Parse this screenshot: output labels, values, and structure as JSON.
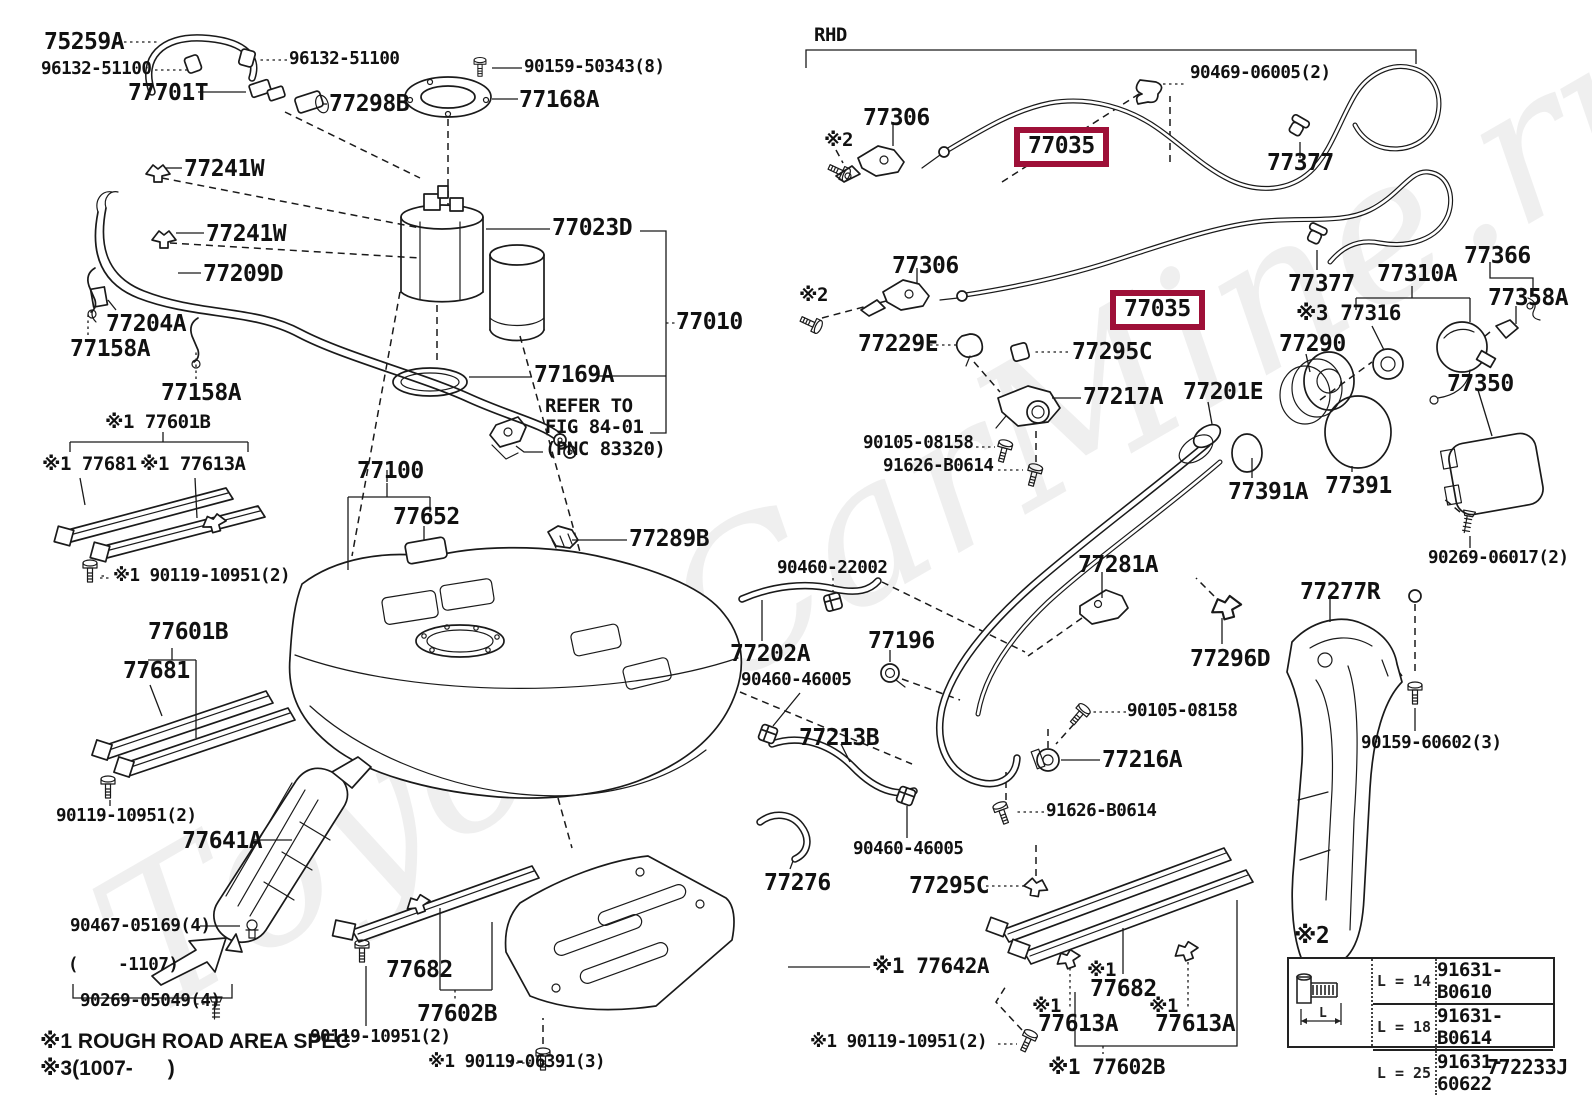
{
  "watermark": "ToyotaCarMine.ru",
  "bolt_table": {
    "dim_label": "L",
    "rows": [
      {
        "len": "L = 14",
        "part": "91631-B0610"
      },
      {
        "len": "L = 18",
        "part": "91631-B0614"
      },
      {
        "len": "L = 25",
        "part": "91631-60622"
      }
    ]
  },
  "labels": [
    {
      "t": "75259A",
      "x": 44,
      "y": 30,
      "s": "b"
    },
    {
      "t": "96132-51100",
      "x": 41,
      "y": 60,
      "s": "s"
    },
    {
      "t": "96132-51100",
      "x": 289,
      "y": 50,
      "s": "s"
    },
    {
      "t": "77701T",
      "x": 128,
      "y": 81,
      "s": "b"
    },
    {
      "t": "77298B",
      "x": 329,
      "y": 92,
      "s": "b"
    },
    {
      "t": "90159-50343(8)",
      "x": 524,
      "y": 58,
      "s": "s"
    },
    {
      "t": "77168A",
      "x": 519,
      "y": 88,
      "s": "b"
    },
    {
      "t": "77023D",
      "x": 552,
      "y": 216,
      "s": "b"
    },
    {
      "t": "77010",
      "x": 676,
      "y": 310,
      "s": "b"
    },
    {
      "t": "77169A",
      "x": 534,
      "y": 363,
      "s": "b"
    },
    {
      "t": "REFER TO\nFIG 84-01\n(PNC 83320)",
      "x": 545,
      "y": 396,
      "s": "ref"
    },
    {
      "t": "77241W",
      "x": 184,
      "y": 157,
      "s": "b"
    },
    {
      "t": "77241W",
      "x": 206,
      "y": 222,
      "s": "b"
    },
    {
      "t": "77209D",
      "x": 203,
      "y": 262,
      "s": "b"
    },
    {
      "t": "77204A",
      "x": 106,
      "y": 312,
      "s": "b"
    },
    {
      "t": "77158A",
      "x": 70,
      "y": 337,
      "s": "b"
    },
    {
      "t": "77158A",
      "x": 161,
      "y": 381,
      "s": "b"
    },
    {
      "t": "※1 77601B",
      "x": 105,
      "y": 412,
      "s": "m"
    },
    {
      "t": "※1 77681",
      "x": 42,
      "y": 454,
      "s": "m"
    },
    {
      "t": "※1 77613A",
      "x": 140,
      "y": 454,
      "s": "m"
    },
    {
      "t": "※1 90119-10951(2)",
      "x": 113,
      "y": 567,
      "s": "s"
    },
    {
      "t": "77100",
      "x": 357,
      "y": 459,
      "s": "b"
    },
    {
      "t": "77652",
      "x": 393,
      "y": 505,
      "s": "b"
    },
    {
      "t": "77289B",
      "x": 629,
      "y": 527,
      "s": "b"
    },
    {
      "t": "77601B",
      "x": 148,
      "y": 620,
      "s": "b"
    },
    {
      "t": "77681",
      "x": 123,
      "y": 659,
      "s": "b"
    },
    {
      "t": "90119-10951(2)",
      "x": 56,
      "y": 807,
      "s": "s"
    },
    {
      "t": "77641A",
      "x": 182,
      "y": 829,
      "s": "b"
    },
    {
      "t": "90467-05169(4)",
      "x": 70,
      "y": 917,
      "s": "s"
    },
    {
      "t": "(    -1107)",
      "x": 68,
      "y": 956,
      "s": "s"
    },
    {
      "t": "90269-05049(4)",
      "x": 80,
      "y": 992,
      "s": "s"
    },
    {
      "t": "※1 ROUGH ROAD AREA SPEC",
      "x": 40,
      "y": 1030,
      "s": "n",
      "n": "note-label"
    },
    {
      "t": "※3(1007-      )",
      "x": 40,
      "y": 1057,
      "s": "n",
      "n": "note-label"
    },
    {
      "t": "77682",
      "x": 386,
      "y": 958,
      "s": "b"
    },
    {
      "t": "77602B",
      "x": 417,
      "y": 1002,
      "s": "b"
    },
    {
      "t": "90119-10951(2)",
      "x": 310,
      "y": 1028,
      "s": "s"
    },
    {
      "t": "※1 90119-06391(3)",
      "x": 428,
      "y": 1053,
      "s": "s"
    },
    {
      "t": "90460-22002",
      "x": 777,
      "y": 559,
      "s": "s"
    },
    {
      "t": "77202A",
      "x": 730,
      "y": 642,
      "s": "b"
    },
    {
      "t": "90460-46005",
      "x": 741,
      "y": 671,
      "s": "s"
    },
    {
      "t": "77196",
      "x": 868,
      "y": 629,
      "s": "b"
    },
    {
      "t": "77213B",
      "x": 799,
      "y": 726,
      "s": "b"
    },
    {
      "t": "90460-46005",
      "x": 853,
      "y": 840,
      "s": "s"
    },
    {
      "t": "77276",
      "x": 764,
      "y": 871,
      "s": "b"
    },
    {
      "t": "77295C",
      "x": 909,
      "y": 874,
      "s": "b"
    },
    {
      "t": "91626-B0614",
      "x": 1046,
      "y": 802,
      "s": "s"
    },
    {
      "t": "※1 77642A",
      "x": 872,
      "y": 955,
      "s": "bm"
    },
    {
      "t": "※1 90119-10951(2)",
      "x": 810,
      "y": 1033,
      "s": "s"
    },
    {
      "t": "※1",
      "x": 1087,
      "y": 960,
      "s": "m"
    },
    {
      "t": "77682",
      "x": 1090,
      "y": 977,
      "s": "b"
    },
    {
      "t": "※1",
      "x": 1032,
      "y": 996,
      "s": "m"
    },
    {
      "t": "77613A",
      "x": 1038,
      "y": 1012,
      "s": "b"
    },
    {
      "t": "※1",
      "x": 1149,
      "y": 996,
      "s": "m"
    },
    {
      "t": "77613A",
      "x": 1155,
      "y": 1012,
      "s": "b"
    },
    {
      "t": "※1 77602B",
      "x": 1048,
      "y": 1056,
      "s": "bm"
    },
    {
      "t": "※2",
      "x": 1294,
      "y": 924,
      "s": "b"
    },
    {
      "t": "772233J",
      "x": 1487,
      "y": 1056,
      "s": "s2",
      "n": "diagram-code-label"
    },
    {
      "t": "RHD",
      "x": 814,
      "y": 25,
      "s": "m",
      "n": "rhd-label"
    },
    {
      "t": "77306",
      "x": 863,
      "y": 106,
      "s": "b"
    },
    {
      "t": "※2",
      "x": 824,
      "y": 130,
      "s": "m"
    },
    {
      "t": "90469-06005(2)",
      "x": 1190,
      "y": 64,
      "s": "s"
    },
    {
      "t": "77377",
      "x": 1267,
      "y": 151,
      "s": "b"
    },
    {
      "t": "77306",
      "x": 892,
      "y": 254,
      "s": "b"
    },
    {
      "t": "※2",
      "x": 799,
      "y": 285,
      "s": "m"
    },
    {
      "t": "77377",
      "x": 1288,
      "y": 272,
      "s": "b"
    },
    {
      "t": "77229E",
      "x": 858,
      "y": 332,
      "s": "b"
    },
    {
      "t": "77295C",
      "x": 1072,
      "y": 340,
      "s": "b"
    },
    {
      "t": "77217A",
      "x": 1083,
      "y": 385,
      "s": "b"
    },
    {
      "t": "90105-08158",
      "x": 863,
      "y": 434,
      "s": "s"
    },
    {
      "t": "91626-B0614",
      "x": 883,
      "y": 457,
      "s": "s"
    },
    {
      "t": "77310A",
      "x": 1377,
      "y": 262,
      "s": "b"
    },
    {
      "t": "77366",
      "x": 1464,
      "y": 244,
      "s": "b"
    },
    {
      "t": "77358A",
      "x": 1488,
      "y": 286,
      "s": "b"
    },
    {
      "t": "※3 77316",
      "x": 1296,
      "y": 302,
      "s": "bm"
    },
    {
      "t": "77290",
      "x": 1279,
      "y": 332,
      "s": "b"
    },
    {
      "t": "77201E",
      "x": 1183,
      "y": 380,
      "s": "b"
    },
    {
      "t": "77391A",
      "x": 1228,
      "y": 480,
      "s": "b"
    },
    {
      "t": "77391",
      "x": 1325,
      "y": 474,
      "s": "b"
    },
    {
      "t": "77350",
      "x": 1447,
      "y": 372,
      "s": "b"
    },
    {
      "t": "90269-06017(2)",
      "x": 1428,
      "y": 549,
      "s": "s"
    },
    {
      "t": "77281A",
      "x": 1078,
      "y": 553,
      "s": "b"
    },
    {
      "t": "77296D",
      "x": 1190,
      "y": 647,
      "s": "b"
    },
    {
      "t": "77277R",
      "x": 1300,
      "y": 580,
      "s": "b"
    },
    {
      "t": "90105-08158",
      "x": 1127,
      "y": 702,
      "s": "s"
    },
    {
      "t": "77216A",
      "x": 1102,
      "y": 748,
      "s": "b"
    },
    {
      "t": "90159-60602(3)",
      "x": 1361,
      "y": 734,
      "s": "s"
    },
    {
      "t": "77035",
      "x": 1014,
      "y": 127,
      "s": "hl",
      "n": "highlighted-part-label"
    },
    {
      "t": "77035",
      "x": 1110,
      "y": 290,
      "s": "hl",
      "n": "highlighted-part-label"
    }
  ]
}
